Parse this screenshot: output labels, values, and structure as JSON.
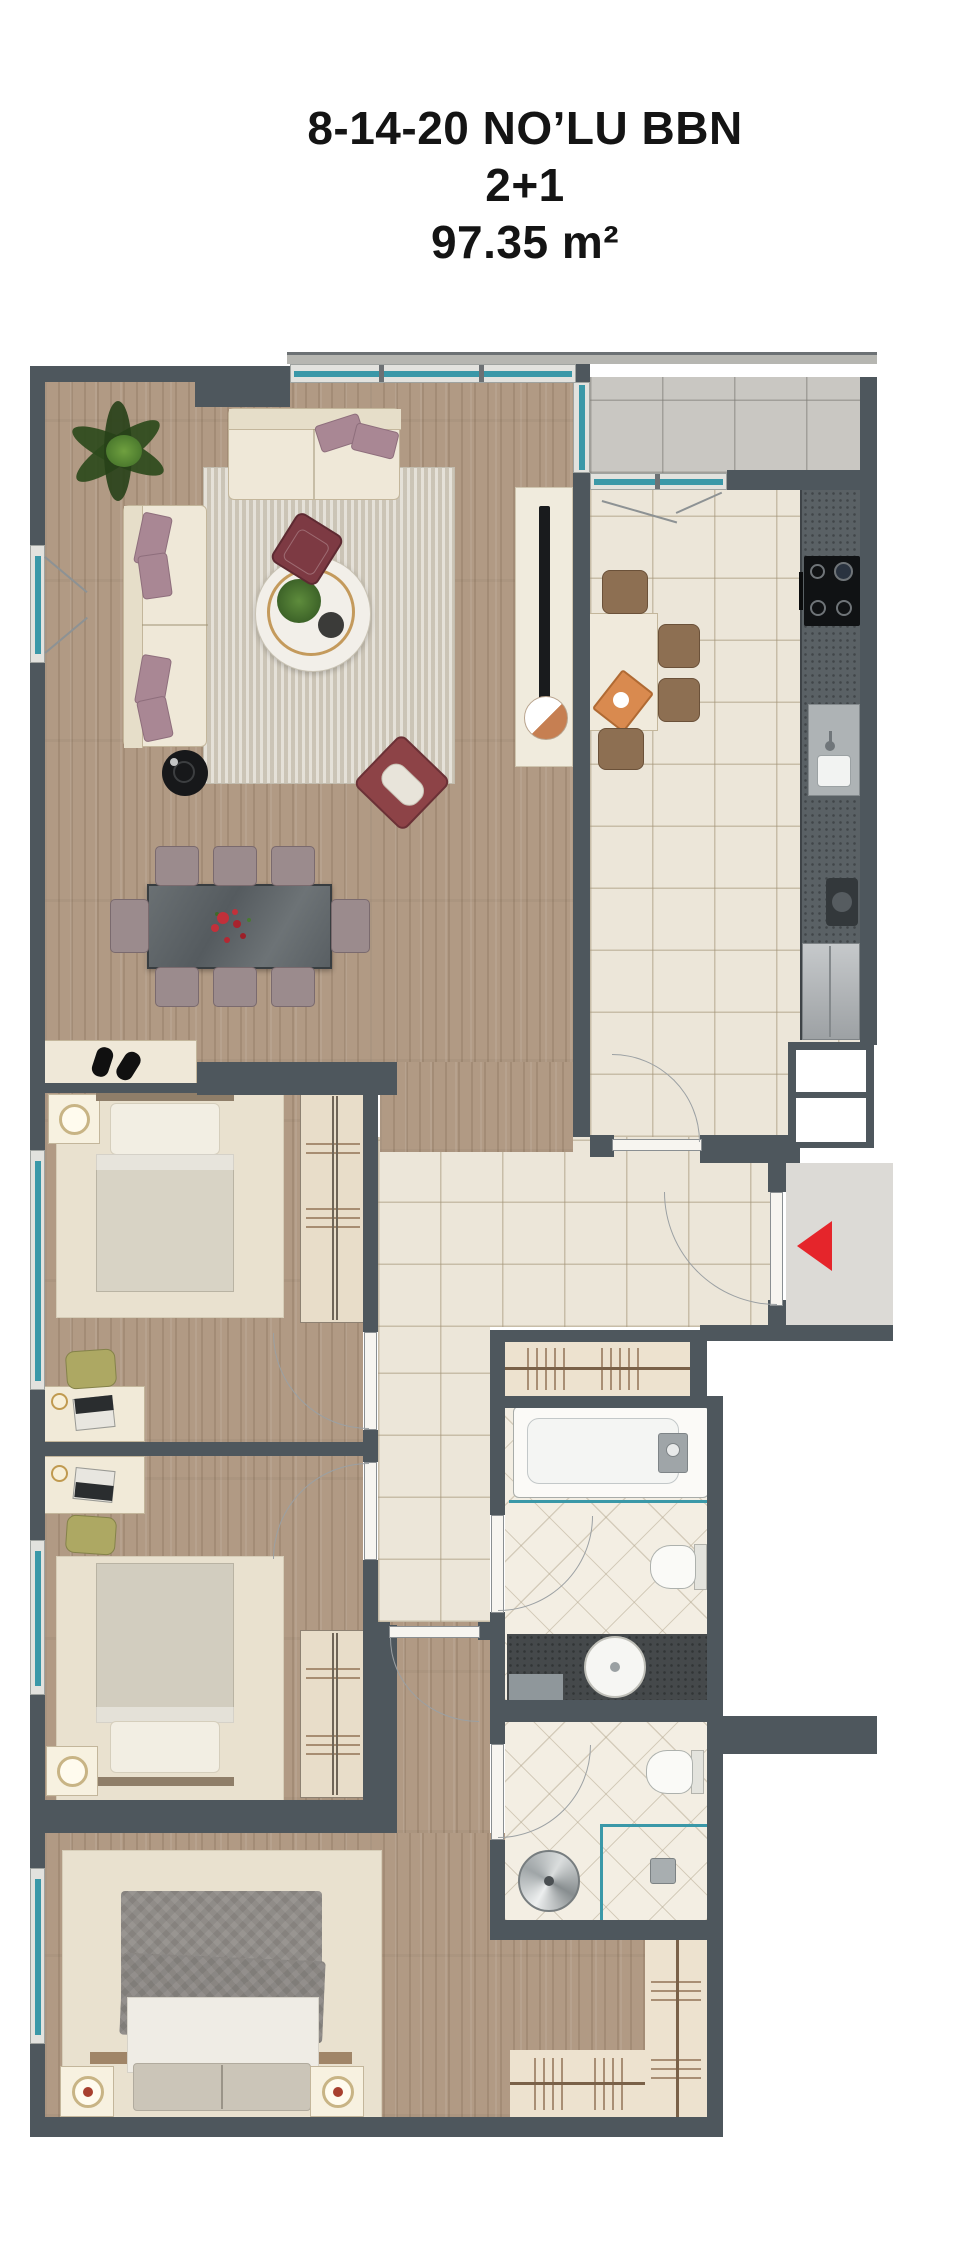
{
  "title": {
    "line1": "8-14-20 NO’LU BBN",
    "line2": "2+1",
    "line3": "97.35 m²"
  },
  "entry": {
    "icon": "entry-direction-arrow",
    "arrow_color": "#E5252B"
  },
  "colors": {
    "wall": "#4E575D",
    "window_glass": "#3A98A8",
    "wood_floor": "#B19A84",
    "ceramic_tile": "#ECE6D9",
    "bathroom_tile": "#F3EEE3",
    "balcony_tile": "#C9C7C2",
    "exterior_floor": "#DCDAD6"
  }
}
